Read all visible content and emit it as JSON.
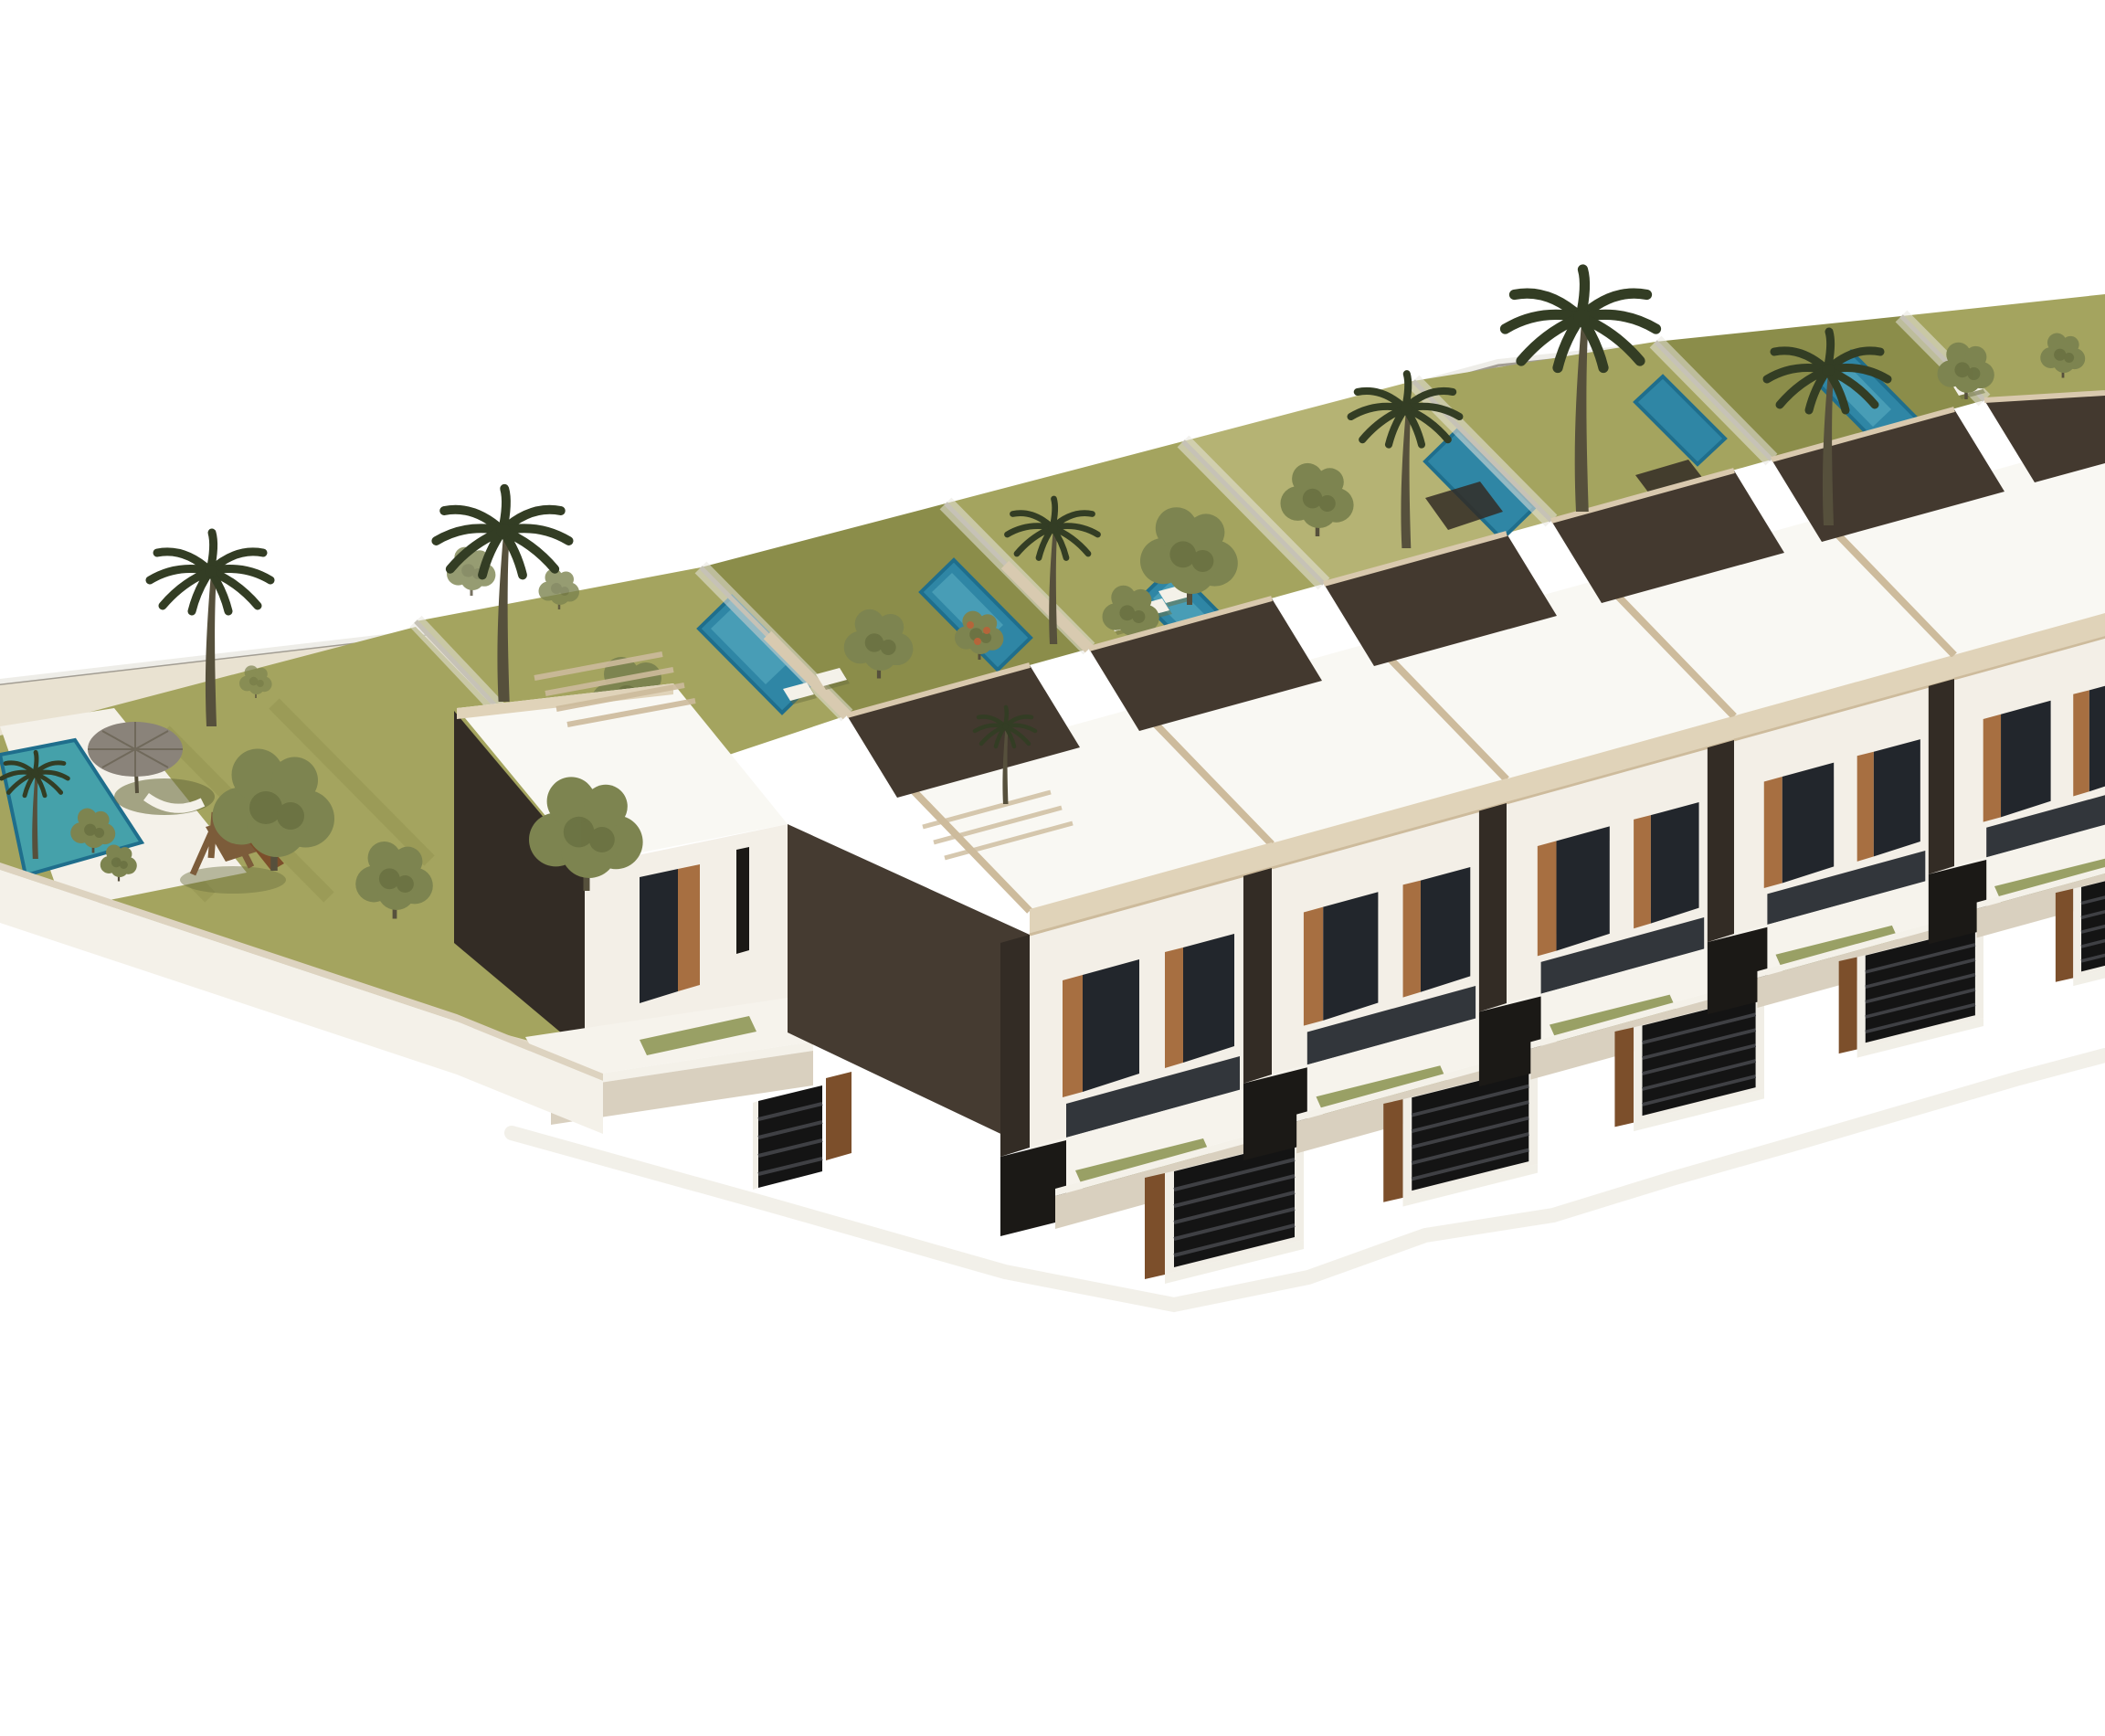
{
  "scene": {
    "description": "Aerial 3D architectural rendering of a modern townhouse development: a diagonal row of white flat-roofed two-storey houses with wooden window surrounds and slatted entrance gates, private rear gardens with turquoise swimming pools separated by glass fences, and a communal garden on the left with palm trees, a playground, a parasol lounge and a shared pool, all on a plain white background.",
    "style": "computer-generated perspective render",
    "background": "#ffffff"
  },
  "site": {
    "houses_visible": 6,
    "townhouse_units": 5,
    "single_storey_houses": 1,
    "private_gardens": 7,
    "private_pools": 6,
    "communal_pools": 1,
    "palm_trees": 8,
    "trees_and_shrubs": 16,
    "sun_loungers": 6,
    "entrance_gates": 6,
    "features": [
      "communal lawn",
      "children playground",
      "parasol with lounge seat",
      "glass garden fences",
      "white roof terraces",
      "front terraces with planters",
      "dark slatted gates",
      "wood cladding accents"
    ]
  },
  "palette": {
    "white": "#ffffff",
    "boundary": "#a29d93",
    "rearFence": "#d9d6cc",
    "sand": "#e9e2d1",
    "path": "#e0d7c2",
    "lawn": "#a4a45f",
    "lawnDark": "#8b8d4a",
    "lawnLight": "#b5b374",
    "glass": "#e8e6df",
    "glassCore": "#c6c2b6",
    "pool": "#2f86a5",
    "poolLight": "#5db0c4",
    "poolRim": "#1f6e8c",
    "poolCommunal": "#45a1aa",
    "roof": "#f9f8f3",
    "parapet": "#e0d3b9",
    "parapetLine": "#cdbb9c",
    "deck": "#43392f",
    "deckCap": "#d9c9ae",
    "beigeWall": "#d8cab0",
    "darkWall": "#453b31",
    "darkWall2": "#332c25",
    "blackRecess": "#1b1916",
    "facade": "#f3efe7",
    "facadeShade": "#e1dacb",
    "wood": "#a76f41",
    "woodDark": "#7c4f2b",
    "window": "#22262c",
    "terrace": "#f6f3ec",
    "terraceWallShade": "#d9d0bf",
    "wallCap": "#ddd3c0",
    "wallFace": "#f4f1e9",
    "gateFrame": "#f1eee6",
    "gate": "#141414",
    "gateSlat": "#3f4044",
    "planter": "#99a065",
    "planterDark": "#6e7442",
    "palm": "#333d24",
    "trunk": "#56503c",
    "tree": "#7d8450",
    "treeDark": "#5c6337",
    "orangeDot": "#b5653a",
    "umbrella": "#8a837a",
    "umbrellaShade": "#6c7040",
    "playWood": "#7c5c3a",
    "shadow": "#e8e4d7"
  }
}
